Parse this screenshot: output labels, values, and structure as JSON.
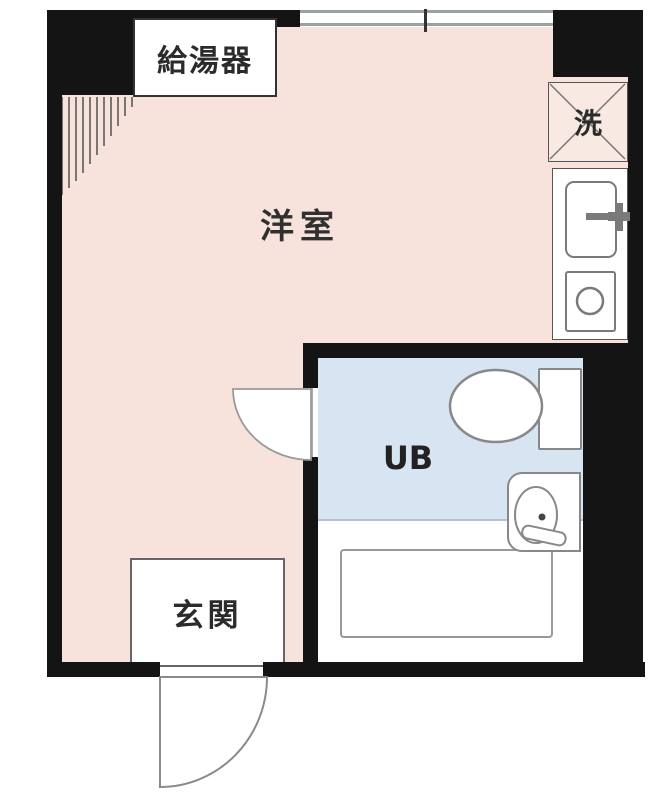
{
  "floorplan": {
    "type": "japanese-apartment-floor-plan",
    "labels": {
      "water_heater": "給湯器",
      "laundry": "洗",
      "main_room": "洋室",
      "unit_bath": "UB",
      "entrance": "玄関"
    },
    "fixtures": [
      "window-symbol",
      "hatch-pattern",
      "kitchen-sink-icon",
      "kitchen-faucet-icon",
      "stove-burner-icon",
      "laundry-cross-icon",
      "toilet-icon",
      "washbasin-icon",
      "bathtub-icon",
      "ub-door-swing-icon",
      "entrance-door-swing-icon"
    ],
    "colors": {
      "wall": "#141414",
      "main_room_fill": "#f8e3dc",
      "unit_bath_fill": "#d7e4f2",
      "laundry_fill": "#f8eae3",
      "fixture_line": "#888888",
      "window_line": "#99a29f",
      "text": "#2b2b2b"
    }
  }
}
